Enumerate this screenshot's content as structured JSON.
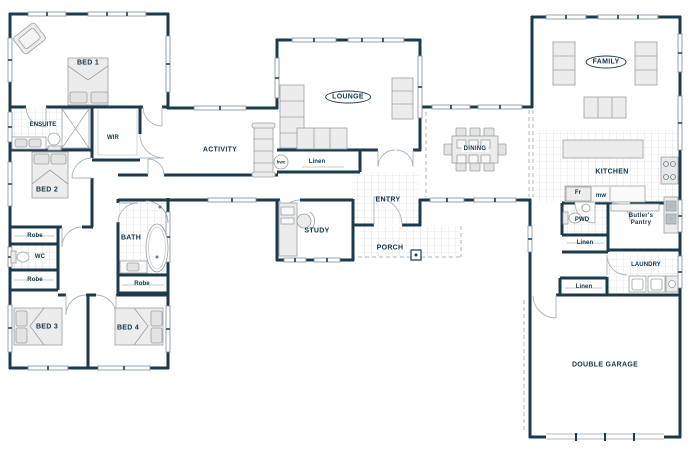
{
  "floorplan": {
    "labels": {
      "bed1": "BED 1",
      "ensuite": "ENSUITE",
      "wir": "WIR",
      "bed2": "BED 2",
      "robe_bed2": "Robe",
      "wc": "WC",
      "robe_hall": "Robe",
      "bed3": "BED 3",
      "bed4": "BED 4",
      "bath": "BATH",
      "robe_bath": "Robe",
      "activity": "ACTIVITY",
      "lounge": "LOUNGE",
      "hwc": "hwc",
      "linen_lounge": "Linen",
      "study": "STUDY",
      "entry": "ENTRY",
      "porch": "PORCH",
      "dining": "DINING",
      "family": "FAMILY",
      "kitchen": "KITCHEN",
      "fridge": "Fr",
      "microwave": "mw",
      "pwd": "PWD",
      "butlers_pantry": "Butler's Pantry",
      "linen_hall_upper": "Linen",
      "laundry": "LAUNDRY",
      "linen_hall_lower": "Linen",
      "double_garage": "DOUBLE GARAGE"
    },
    "colors": {
      "wall": "#1c3a4d",
      "label_text": "#0f334a",
      "furniture_fill": "#ececec",
      "furniture_stroke": "#9aa0a4",
      "tile_line": "#cfd4d8",
      "window_line": "#7d8f9b",
      "background": "#ffffff"
    }
  }
}
